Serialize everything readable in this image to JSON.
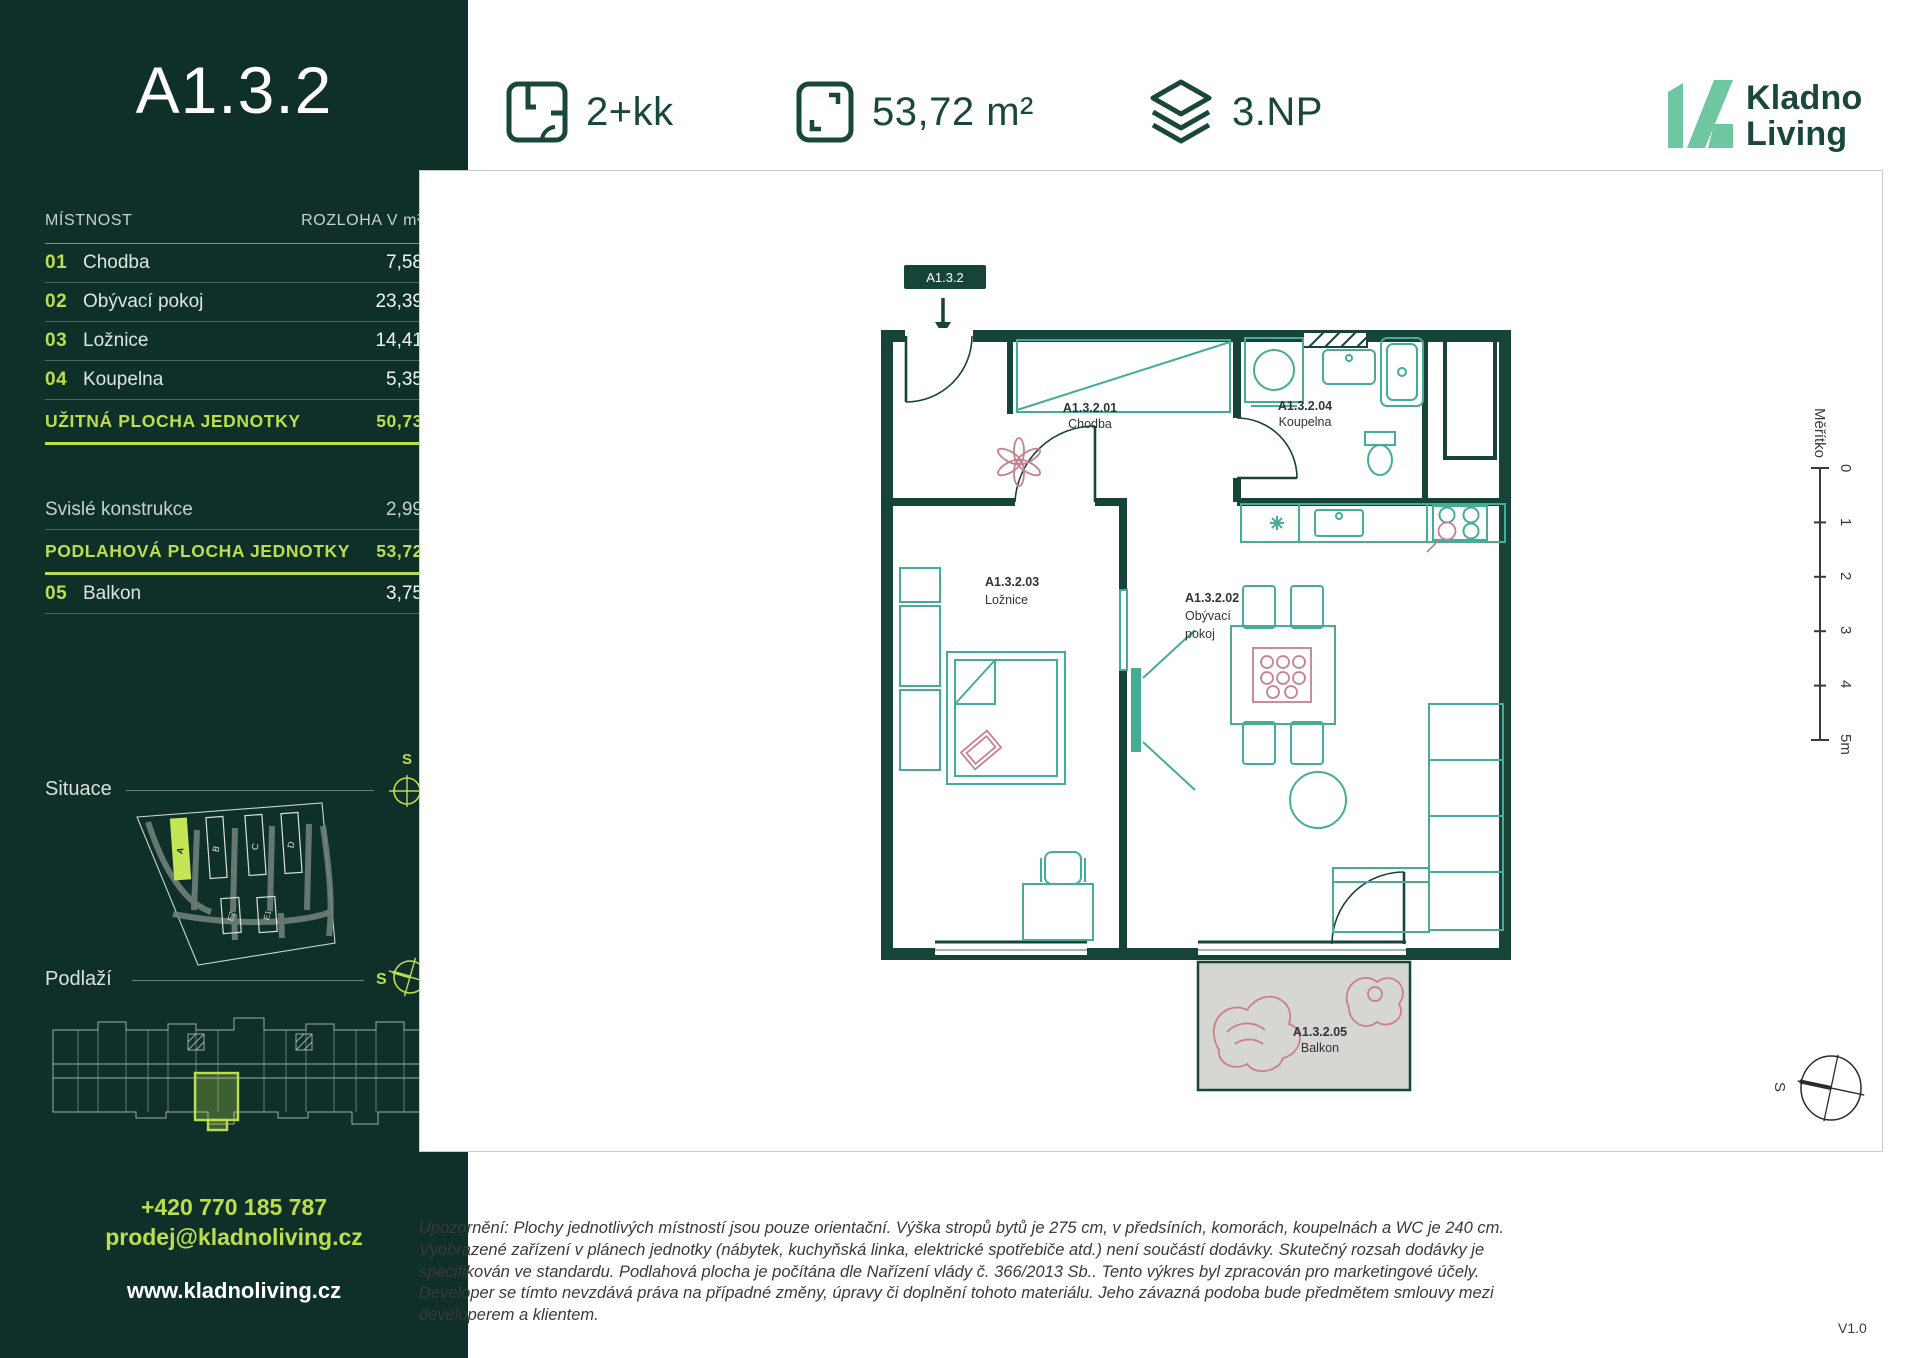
{
  "sidebar": {
    "unit_id": "A1.3.2",
    "table": {
      "header": {
        "room": "MÍSTNOST",
        "area": "ROZLOHA V m²"
      },
      "rows": [
        {
          "num": "01",
          "name": "Chodba",
          "area": "7,58"
        },
        {
          "num": "02",
          "name": "Obývací pokoj",
          "area": "23,39"
        },
        {
          "num": "03",
          "name": "Ložnice",
          "area": "14,41"
        },
        {
          "num": "04",
          "name": "Koupelna",
          "area": "5,35"
        }
      ],
      "usable_label": "UŽITNÁ PLOCHA JEDNOTKY",
      "usable_value": "50,73",
      "vertical_label": "Svislé konstrukce",
      "vertical_value": "2,99",
      "floor_label": "PODLAHOVÁ PLOCHA JEDNOTKY",
      "floor_value": "53,72",
      "balcony_num": "05",
      "balcony_name": "Balkon",
      "balcony_value": "3,75"
    },
    "situace": {
      "label": "Situace",
      "compass_letter": "S",
      "buildings": [
        "A",
        "B",
        "C",
        "D",
        "E2",
        "E1"
      ],
      "highlighted_building": "A"
    },
    "podlazi": {
      "label": "Podlaží",
      "compass_letter": "S"
    },
    "contact": {
      "phone": "+420 770 185 787",
      "email": "prodej@kladnoliving.cz",
      "web": "www.kladnoliving.cz"
    }
  },
  "header": {
    "layout_label": "2+kk",
    "area_label": "53,72 m²",
    "floor_label": "3.NP",
    "logo": {
      "line1": "Kladno",
      "line2": "Living"
    }
  },
  "plan": {
    "unit_badge": "A1.3.2",
    "rooms": [
      {
        "id": "A1.3.2.01",
        "name": "Chodba"
      },
      {
        "id": "A1.3.2.04",
        "name": "Koupelna"
      },
      {
        "id": "A1.3.2.03",
        "name": "Ložnice"
      },
      {
        "id": "A1.3.2.02",
        "name": "Obývací pokoj",
        "name_lines": [
          "Obývací",
          "pokoj"
        ]
      },
      {
        "id": "A1.3.2.05",
        "name": "Balkon"
      }
    ],
    "scale": {
      "label": "Měřítko",
      "ticks": [
        "0",
        "1",
        "2",
        "3",
        "4",
        "5m"
      ]
    },
    "compass_letter": "S"
  },
  "footer": {
    "disclaimer": "Upozornění: Plochy jednotlivých místností jsou pouze orientační. Výška stropů bytů je 275 cm, v předsíních, komorách, koupelnách a WC je 240 cm. Vyobrazené zařízení v plánech jednotky (nábytek, kuchyňská linka, elektrické spotřebiče atd.) není součástí dodávky. Skutečný rozsah dodávky je specifikován ve standardu. Podlahová plocha je počítána dle Nařízení vlády č. 366/2013 Sb.. Tento výkres byl zpracován pro marketingové účely. Developer se tímto nevzdává práva na případné změny, úpravy či doplnění tohoto materiálu. Jeho závazná podoba bude předmětem smlouvy mezi developerem a klientem.",
    "version": "V1.0"
  },
  "colors": {
    "sidebar_bg": "#0F2F29",
    "accent_lime": "#BBDF4C",
    "dark_green": "#1A473C",
    "wall_green": "#174438",
    "furniture_teal": "#45AC97",
    "pink": "#C9808E",
    "logo_mint": "#6FC7A2",
    "balcony_gray": "#D6D6D3"
  }
}
